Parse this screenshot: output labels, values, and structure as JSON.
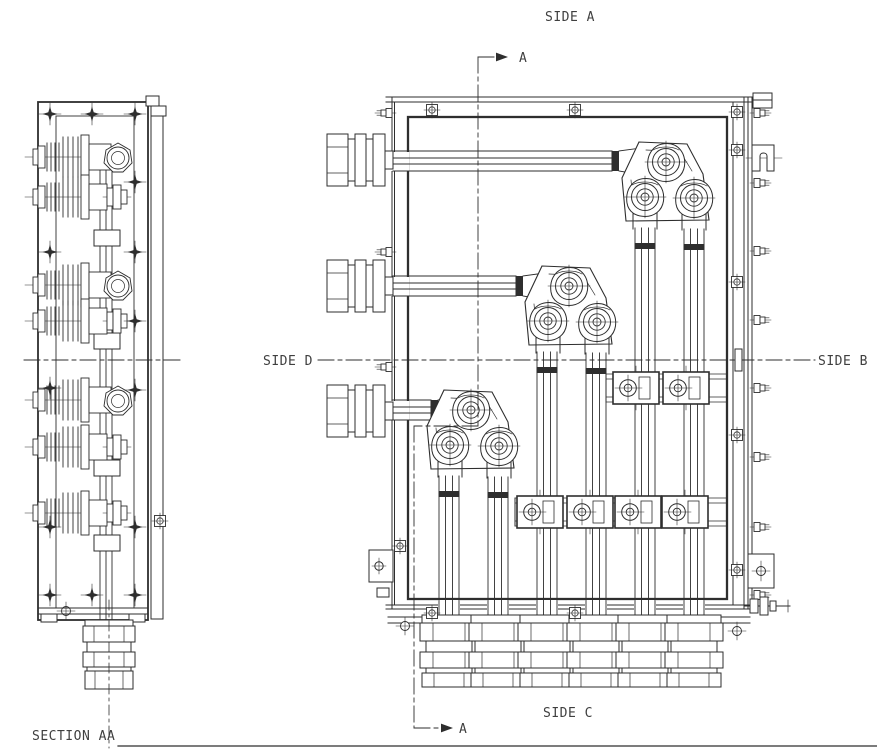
{
  "drawing": {
    "background": "#ffffff",
    "line_color": "#2e2e2e",
    "text_color": "#3f3f3f",
    "labels": {
      "side_a": "SIDE A",
      "side_b": "SIDE B",
      "side_c": "SIDE C",
      "side_d": "SIDE D",
      "section_view_title": "SECTION AA",
      "cut_arrow_top": "A",
      "cut_arrow_bottom": "A"
    }
  }
}
